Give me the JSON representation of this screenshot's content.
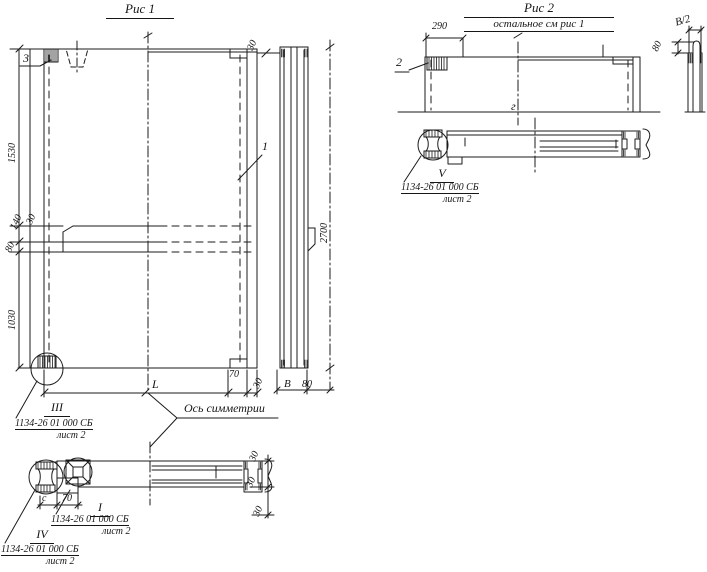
{
  "fig1": {
    "title": "Рис 1",
    "labels": {
      "p3": "3",
      "p1": "1"
    },
    "dims": {
      "v1530": "1530",
      "v140": "140",
      "v30step": "30",
      "v80": "80",
      "v1030": "1030",
      "top30": "30",
      "v2700": "2700",
      "L": "L",
      "b70": "70",
      "b30": "30",
      "B": "В",
      "b80": "80"
    },
    "axis_caption": "Ось симметрии",
    "section_dims": {
      "c": "с",
      "s70": "70",
      "s30a": "30",
      "s30b": "30",
      "s30c": "30"
    },
    "details": {
      "iii": {
        "num": "III",
        "ref": "1134-26 01 000 СБ",
        "sheet": "лист 2"
      },
      "i": {
        "num": "I",
        "ref": "1134-26 01 000 СБ",
        "sheet": "лист 2"
      },
      "iv": {
        "num": "IV",
        "ref": "1134-26 01 000 СБ",
        "sheet": "лист 2"
      }
    }
  },
  "fig2": {
    "title": "Рис 2",
    "subtitle": "остальное см рис 1",
    "labels": {
      "p2": "2"
    },
    "dims": {
      "w290": "290",
      "b2": "В/2",
      "v80": "80"
    },
    "axis_mark": "г",
    "details": {
      "v": {
        "num": "V",
        "ref": "1134-26 01 000 СБ",
        "sheet": "лист 2"
      }
    }
  }
}
